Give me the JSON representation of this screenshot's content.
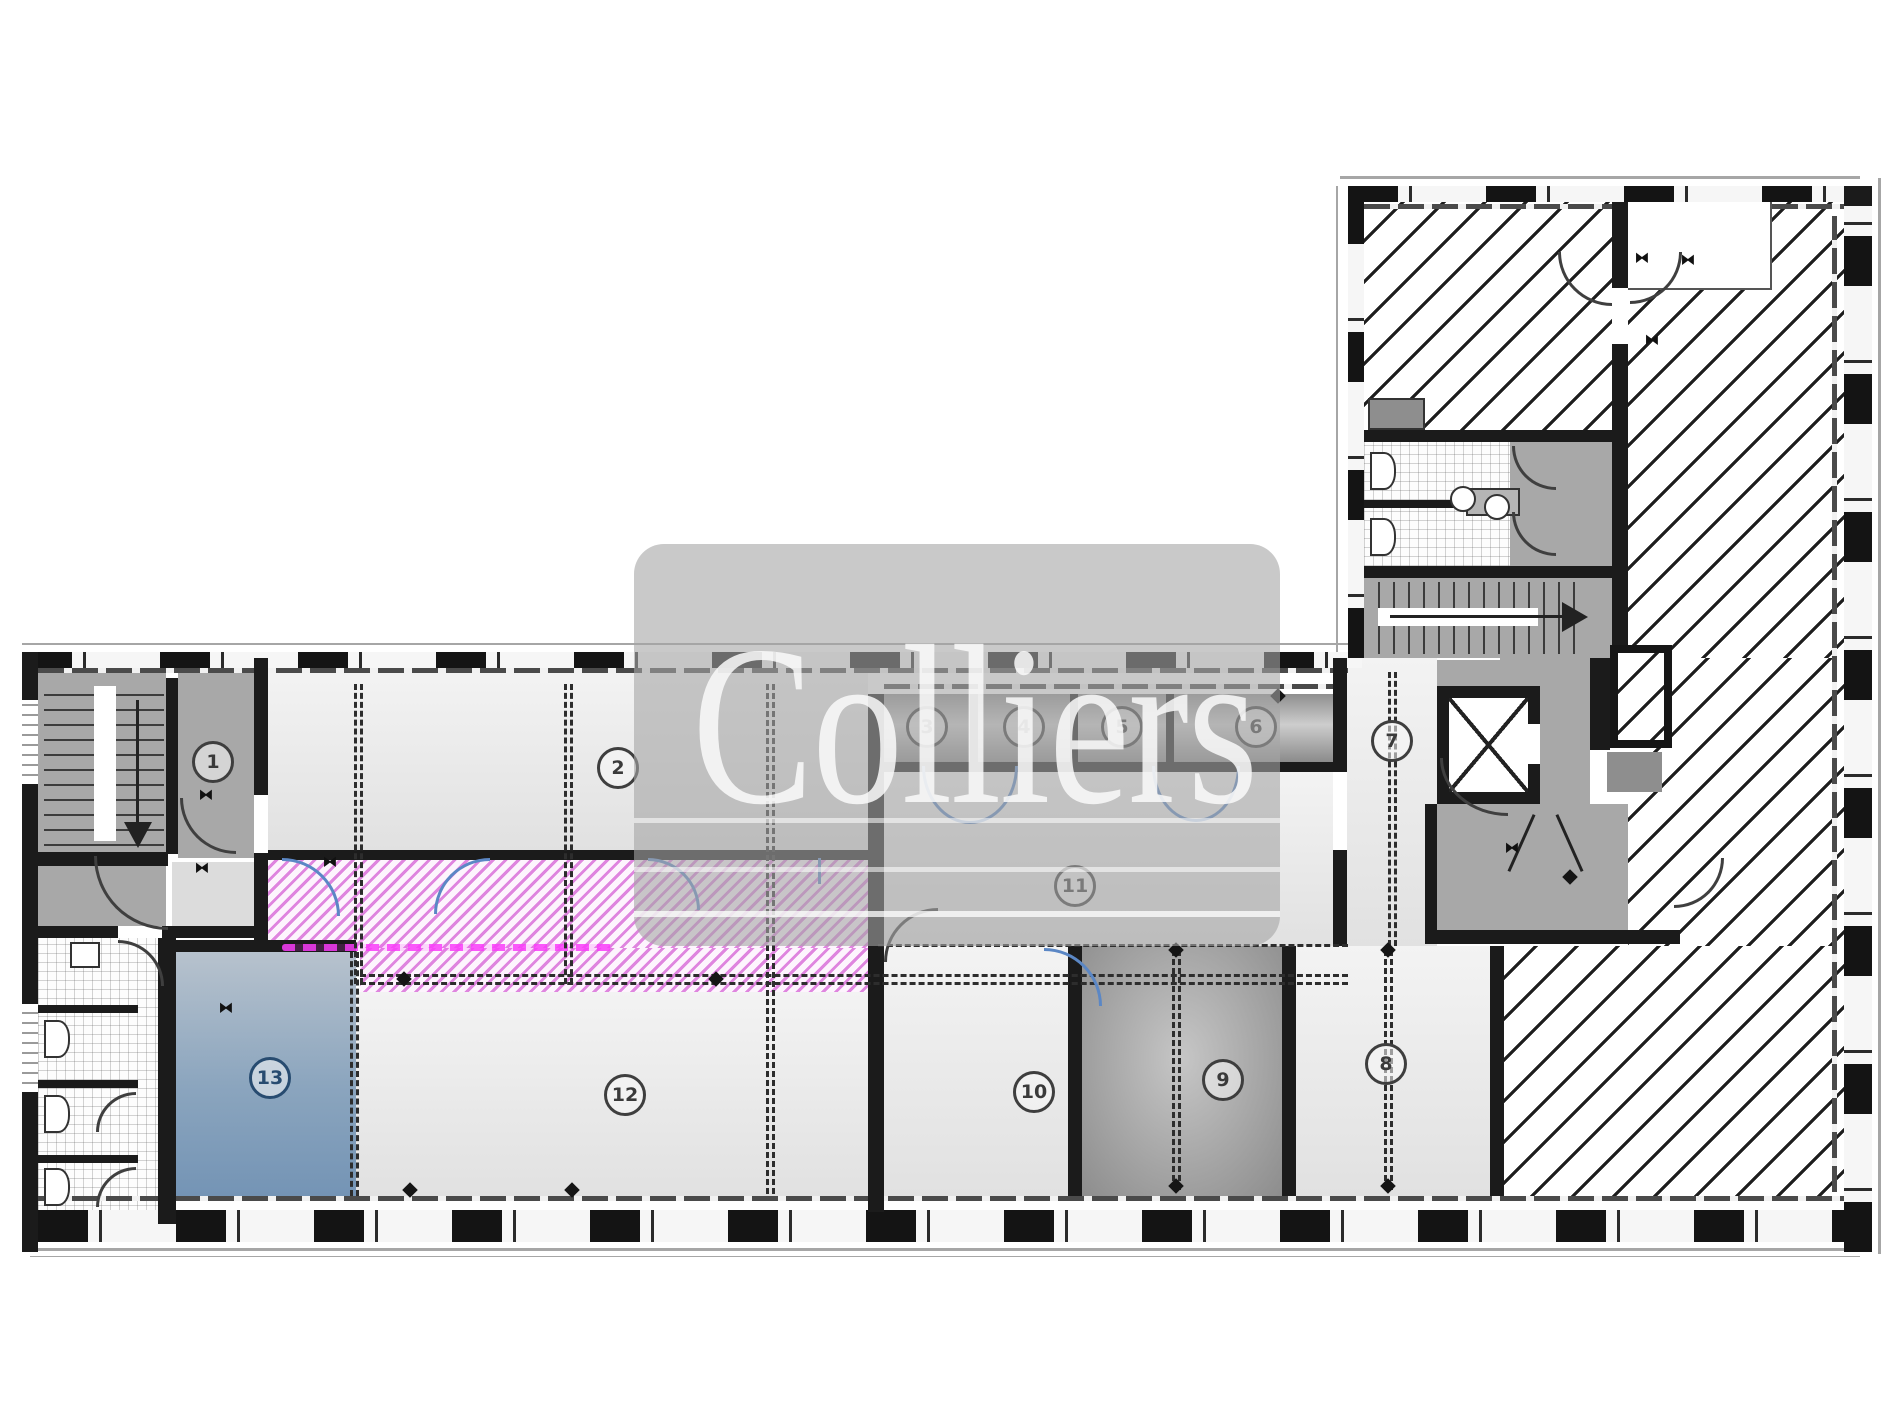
{
  "watermark": {
    "brand": "Colliers"
  },
  "rooms": {
    "r1": {
      "label": "1"
    },
    "r2": {
      "label": "2"
    },
    "r3": {
      "label": "3"
    },
    "r4": {
      "label": "4"
    },
    "r5": {
      "label": "5"
    },
    "r6": {
      "label": "6"
    },
    "r7": {
      "label": "7"
    },
    "r8": {
      "label": "8"
    },
    "r9": {
      "label": "9"
    },
    "r10": {
      "label": "10"
    },
    "r11": {
      "label": "11"
    },
    "r12": {
      "label": "12"
    },
    "r13": {
      "label": "13"
    }
  },
  "colors": {
    "wall": "#1b1b1b",
    "corridor_highlight_hatch": "#df85df",
    "room13_fill_top": "#b7c2cd",
    "room13_fill_bottom": "#7494b5",
    "room9_fill": "#9b9b9b",
    "new_door_blue": "#5b87c5",
    "watermark_gray": "#c9c9c9"
  }
}
